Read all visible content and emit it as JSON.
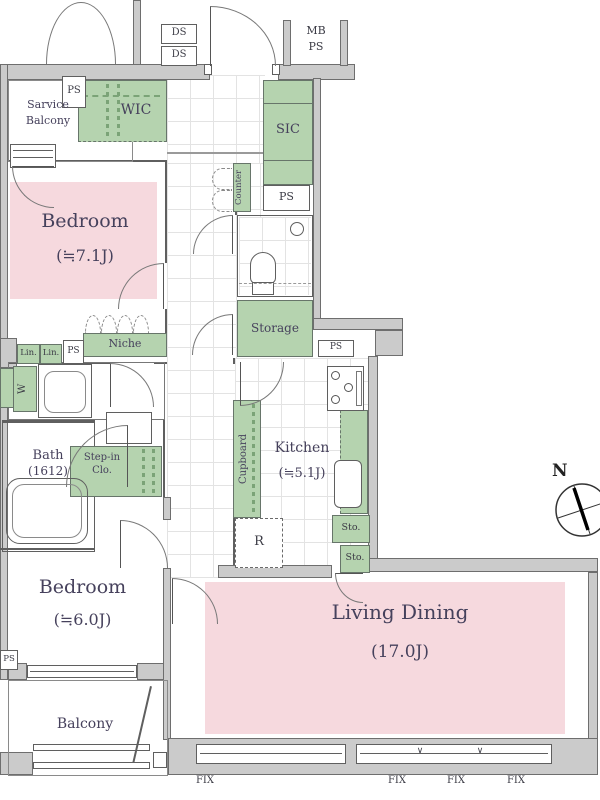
{
  "title": "apartment floor plan",
  "rooms": {
    "bedroom_top": {
      "name": "Bedroom",
      "size": "(≒7.1J)"
    },
    "bedroom_bottom": {
      "name": "Bedroom",
      "size": "(≒6.0J)"
    },
    "living_dining": {
      "name": "Living Dining",
      "size": "(17.0J)"
    },
    "kitchen": {
      "name": "Kitchen",
      "size": "(≒5.1J)"
    },
    "bath": {
      "name": "Bath",
      "size": "(1612)"
    },
    "service_balcony": {
      "line1": "Sarvice",
      "line2": "Balcony"
    },
    "balcony": {
      "name": "Balcony"
    },
    "wic": {
      "name": "WIC"
    },
    "sic": {
      "name": "SIC"
    },
    "storage": {
      "name": "Storage"
    },
    "niche": {
      "name": "Niche"
    },
    "counter": {
      "name": "Counter"
    },
    "cupboard": {
      "name": "Cupboard"
    },
    "step_in_closet": {
      "line1": "Step-in",
      "line2": "Clo."
    }
  },
  "labels": {
    "ds_1": "DS",
    "ds_2": "DS",
    "mb_ps_line1": "MB",
    "mb_ps_line2": "PS",
    "ps_wic": "PS",
    "ps_counter": "PS",
    "ps_storage": "PS",
    "ps_washroom": "PS",
    "ps_bedroom": "PS",
    "lin_1": "Lin.",
    "lin_2": "Lin.",
    "washer": "W",
    "refrigerator": "R",
    "sto_1": "Sto.",
    "sto_2": "Sto.",
    "fix_1": "FIX",
    "fix_2": "FIX",
    "fix_3": "FIX",
    "fix_4": "FIX",
    "window_tick_1": "∨",
    "window_tick_2": "∨",
    "north": "N"
  },
  "colors": {
    "tatami_pink": "#f6d9de",
    "closet_green": "#b5d3af",
    "wall_gray": "#cbcbcb"
  }
}
